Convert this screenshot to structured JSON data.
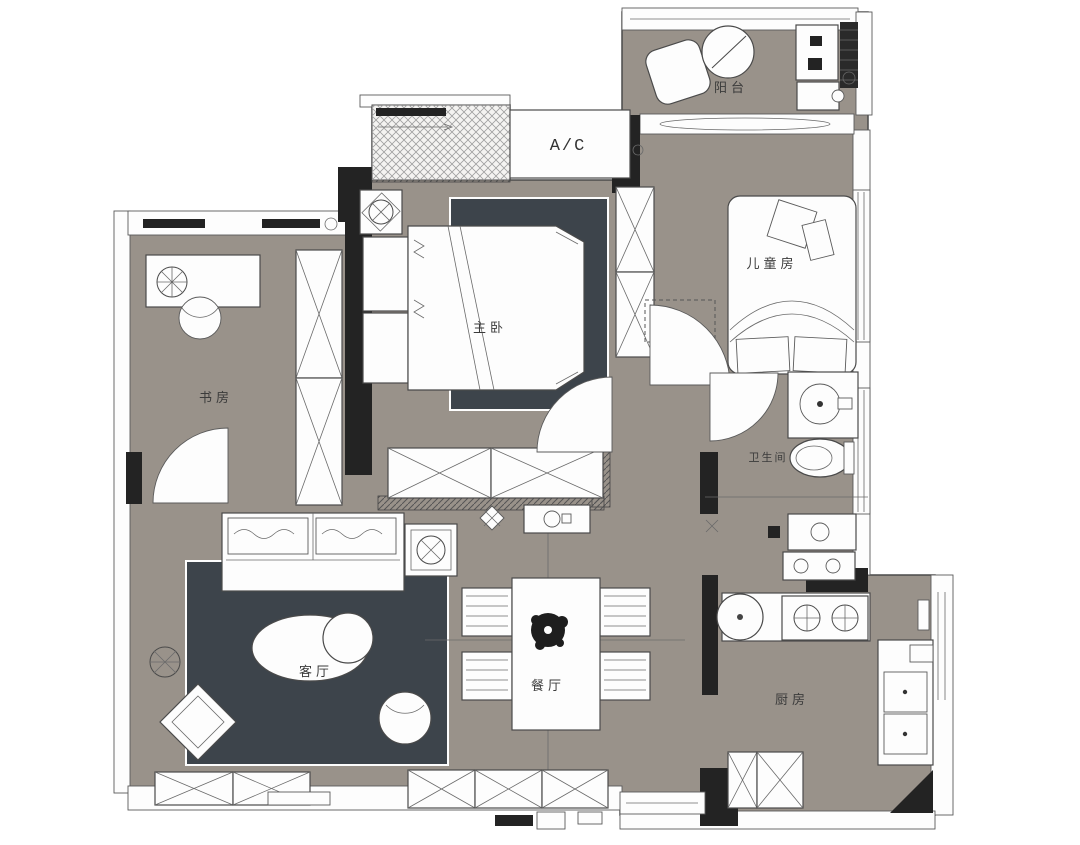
{
  "plan": {
    "type": "apartment-floor-plan",
    "labels": {
      "ac": "A/C",
      "balcony": "阳台",
      "kids_room": "儿童房",
      "master_bedroom": "主卧",
      "study": "书房",
      "bathroom": "卫生间",
      "living_room": "客厅",
      "dining_room": "餐厅",
      "kitchen": "厨房"
    },
    "colors": {
      "floor": "#99928a",
      "rug": "#3d444b",
      "wall": "#232323",
      "furniture": "#fdfdfd",
      "line": "#4a4a4a"
    }
  }
}
